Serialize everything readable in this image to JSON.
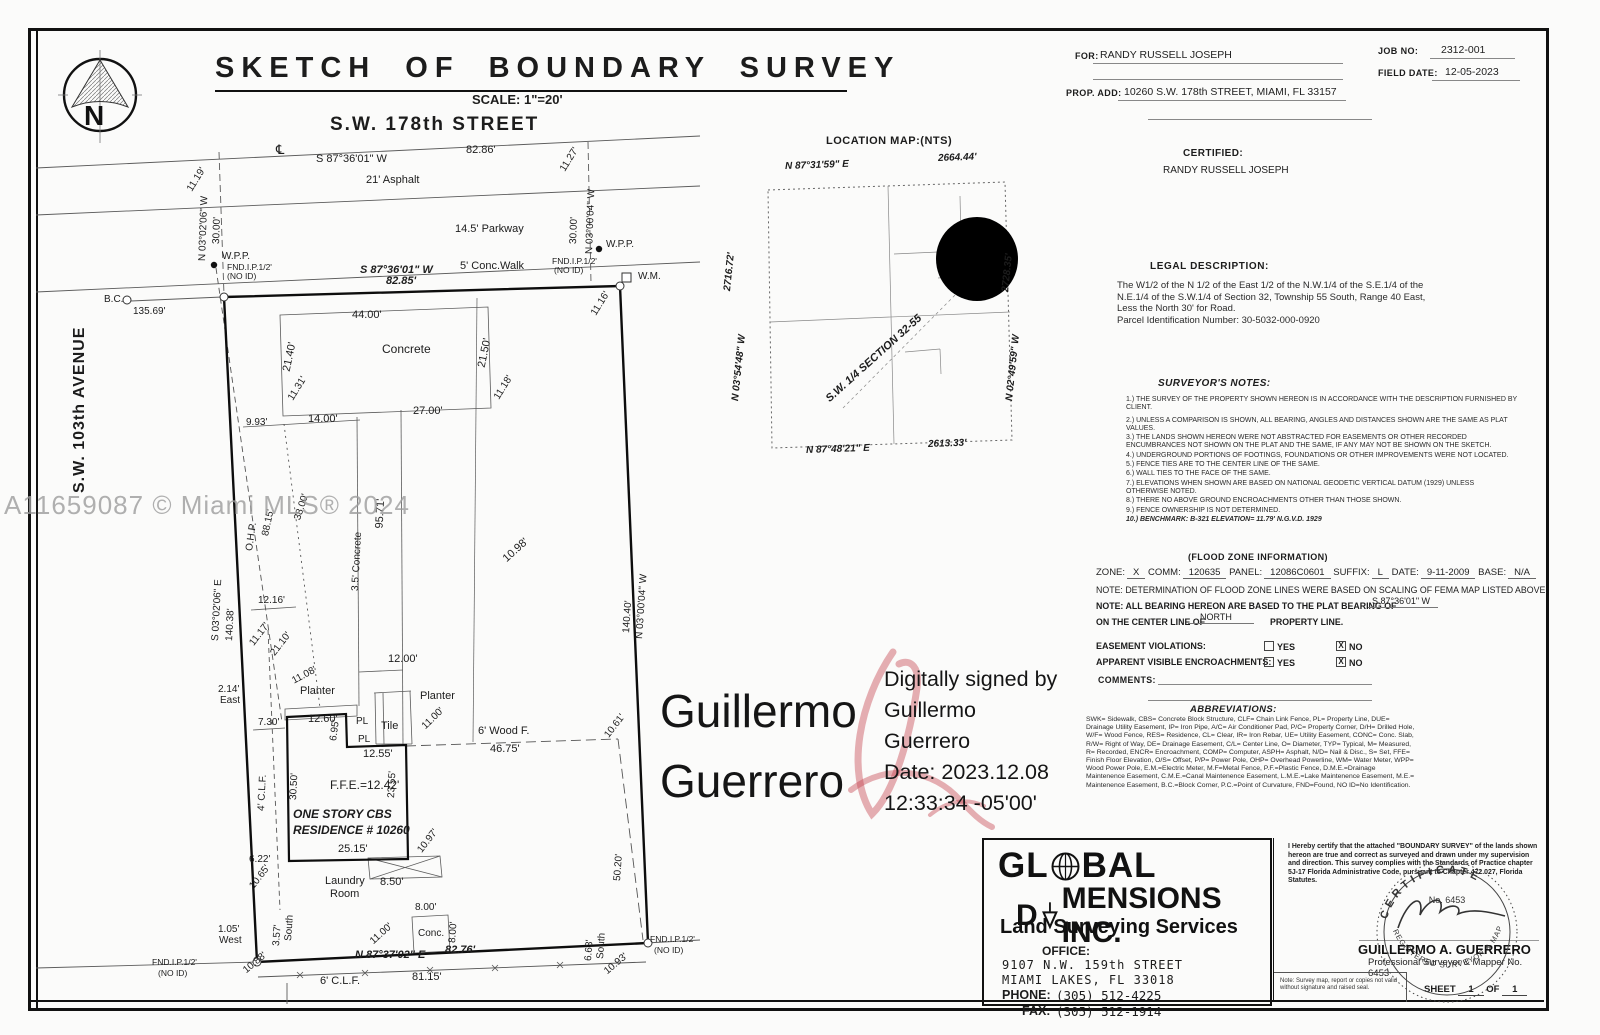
{
  "page": {
    "watermark": "A11659087 © Miami MLS® 2024",
    "north_letter": "N"
  },
  "title": {
    "text": "SKETCH OF BOUNDARY SURVEY",
    "scale": "SCALE: 1\"=20'"
  },
  "header": {
    "for_label": "FOR:",
    "for_value": "RANDY RUSSELL JOSEPH",
    "job_label": "JOB NO:",
    "job_value": "2312-001",
    "field_date_label": "FIELD DATE:",
    "field_date_value": "12-05-2023",
    "prop_label": "PROP. ADD:",
    "prop_value": "10260 S.W. 178th STREET, MIAMI, FL 33157"
  },
  "certified": {
    "label": "CERTIFIED:",
    "value": "RANDY RUSSELL JOSEPH"
  },
  "legal": {
    "heading": "LEGAL DESCRIPTION:",
    "lines": [
      "The W1/2 of the N 1/2 of the East 1/2 of the N.W.1/4 of the S.E.1/4 of the",
      "N.E.1/4 of the S.W.1/4 of Section 32, Township 55 South, Range 40 East,",
      "Less the North 30' for Road.",
      "Parcel Identification Number: 30-5032-000-0920"
    ]
  },
  "surveyor_notes": {
    "heading": "SURVEYOR'S NOTES:",
    "items": [
      "1.) THE SURVEY OF THE PROPERTY SHOWN HEREON IS IN ACCORDANCE WITH THE DESCRIPTION FURNISHED BY CLIENT.",
      "2.) UNLESS A COMPARISON IS SHOWN, ALL BEARING, ANGLES AND DISTANCES SHOWN ARE THE SAME AS PLAT VALUES.",
      "3.) THE LANDS SHOWN HEREON WERE NOT ABSTRACTED FOR EASEMENTS OR OTHER RECORDED ENCUMBRANCES NOT SHOWN ON THE PLAT AND THE SAME, IF ANY MAY NOT BE SHOWN ON THE SKETCH.",
      "4.) UNDERGROUND PORTIONS OF FOOTINGS, FOUNDATIONS OR OTHER IMPROVEMENTS WERE NOT LOCATED.",
      "5.) FENCE TIES ARE TO THE CENTER LINE OF THE SAME.",
      "6.) WALL TIES TO THE FACE OF THE SAME.",
      "7.) ELEVATIONS WHEN SHOWN ARE BASED ON NATIONAL GEODETIC VERTICAL DATUM (1929) UNLESS OTHERWISE NOTED.",
      "8.) THERE NO ABOVE GROUND ENCROACHMENTS OTHER THAN THOSE SHOWN.",
      "9.) FENCE OWNERSHIP IS NOT DETERMINED.",
      "10.) BENCHMARK: B-321 ELEVATION= 11.79' N.G.V.D. 1929"
    ]
  },
  "flood": {
    "heading": "(FLOOD ZONE INFORMATION)",
    "fields": [
      {
        "label": "ZONE:",
        "value": "X"
      },
      {
        "label": "COMM:",
        "value": "120635"
      },
      {
        "label": "PANEL:",
        "value": "12086C0601"
      },
      {
        "label": "SUFFIX:",
        "value": "L"
      },
      {
        "label": "DATE:",
        "value": "9-11-2009"
      },
      {
        "label": "BASE:",
        "value": "N/A"
      }
    ],
    "note1": "NOTE: DETERMINATION OF FLOOD ZONE LINES WERE BASED ON SCALING OF FEMA MAP LISTED ABOVE.",
    "bearing_label": "NOTE: ALL BEARING HEREON ARE BASED TO THE PLAT BEARING OF",
    "bearing_value": "S 87°36'01\" W",
    "centerline_label": "ON THE CENTER LINE OF",
    "centerline_value": "NORTH",
    "centerline_suffix": "PROPERTY LINE.",
    "rows": [
      {
        "label": "EASEMENT VIOLATIONS:",
        "yes": "YES",
        "no": "NO",
        "checked": "no"
      },
      {
        "label": "APPARENT VISIBLE ENCROACHMENTS:",
        "yes": "YES",
        "no": "NO",
        "checked": "no"
      }
    ],
    "check_mark": "X",
    "comments_label": "COMMENTS:"
  },
  "abbreviations": {
    "heading": "ABBREVIATIONS:",
    "text": "SWK= Sidewalk, CBS= Concrete Block Structure, CLF= Chain Link Fence, PL= Property Line, DUE= Drainage Utility Easement, IP= Iron Pipe, A/C= Air Conditioner Pad, P/C= Property Corner, D/H= Drilled Hole, W/F= Wood Fence, RES= Residence, CL= Clear, IR= Iron Rebar, UE= Utility Easement, CONC= Conc. Slab, R/W= Right of Way, DE= Drainage Easement, C/L= Center Line, O= Diameter, TYP= Typical, M= Measured, R= Recorded, ENCR= Encroachment, COMP= Computer, ASPH= Asphalt, N/D= Nail & Disc., S= Set, FFE= Finish Floor Elevation, O/S= Offset, P/P= Power Pole, OHP= Overhead Powerline, WM= Water Meter, WPP= Wood Power Pole, E.M.=Electric Meter, M.F=Metal Fence, P.F.=Plastic Fence, D.M.E.=Drainage Maintenence Easement, C.M.E.=Canal Maintenence Easement, L.M.E.=Lake Maintenence Easement, M.E.= Maintenence Easement, B.C.=Block Corner, P.C.=Point of Curvature, FND=Found, NO ID=No Identification."
  },
  "signature": {
    "name_line1": "Guillermo",
    "name_line2": "Guerrero",
    "details": [
      "Digitally signed by",
      "Guillermo",
      "Guerrero",
      "Date: 2023.12.08",
      "12:33:34 -05'00'"
    ]
  },
  "company": {
    "line1_prefix": "GL",
    "line1_suffix": "BAL",
    "line2_prefix": "D",
    "line2_suffix": "MENSIONS INC.",
    "tagline": "Land Surveying Services",
    "office_label": "OFFICE:",
    "address": [
      "9107 N.W. 159th STREET",
      "MIAMI LAKES, FL 33018"
    ],
    "phone_label": "PHONE:",
    "phone": "(305) 512-4225",
    "fax_label": "FAX:",
    "fax": "(305) 512-1914"
  },
  "certificate": {
    "statement": "I Hereby certify that the attached \"BOUNDARY SURVEY\" of the lands shown hereon are true and correct as surveyed and drawn under my supervision and direction. This survey complies with the Standards of Practice chapter 5J-17 Florida Administrative Code, pursuant to Chapter 472.027, Florida Statutes.",
    "seal": {
      "top": "CERTIFICATE",
      "number": "No. 6453",
      "bottom": "REGISTERED SURVEYOR & MAPPER"
    },
    "name": "GUILLERMO A. GUERRERO",
    "title": "Professional Surveyor & Mapper No. 6453",
    "note": "Note: Survey map, report or copies not valid without signature and raised seal.",
    "sheet_label": "SHEET",
    "sheet_value": "1",
    "of_label": "OF",
    "of_value": "1"
  },
  "location_map": {
    "title": "LOCATION MAP:(NTS)",
    "labels": [
      {
        "t": "N 87°31'59\" E",
        "x": 785,
        "y": 168,
        "s": 10,
        "b": 1,
        "i": 1,
        "r": -2
      },
      {
        "t": "2664.44'",
        "x": 938,
        "y": 160,
        "s": 10,
        "b": 1,
        "i": 1,
        "r": -2
      },
      {
        "t": "2716.72'",
        "x": 728,
        "y": 292,
        "s": 10,
        "b": 1,
        "i": 1,
        "r": -84
      },
      {
        "t": "N 03°54'48\" W",
        "x": 736,
        "y": 402,
        "s": 10,
        "b": 1,
        "i": 1,
        "r": -84
      },
      {
        "t": "2728.35'",
        "x": 1006,
        "y": 293,
        "s": 10,
        "b": 1,
        "i": 1,
        "r": -84
      },
      {
        "t": "N 02°49'59\" W",
        "x": 1010,
        "y": 402,
        "s": 10,
        "b": 1,
        "i": 1,
        "r": -84
      },
      {
        "t": "S.W. 1/4 SECTION 32-55",
        "x": 828,
        "y": 402,
        "s": 11,
        "b": 1,
        "i": 1,
        "r": -42
      },
      {
        "t": "N 87°48'21\" E",
        "x": 806,
        "y": 452,
        "s": 10,
        "b": 1,
        "i": 1,
        "r": -2
      },
      {
        "t": "2613.33'",
        "x": 928,
        "y": 446,
        "s": 10,
        "b": 1,
        "i": 1,
        "r": -2
      }
    ]
  },
  "sketch": {
    "labels": [
      {
        "t": "S.W. 178th STREET",
        "x": 330,
        "y": 127,
        "s": 19,
        "b": 1,
        "ls": 2
      },
      {
        "t": "℄",
        "x": 276,
        "y": 151,
        "s": 13
      },
      {
        "t": "S 87°36'01\" W",
        "x": 316,
        "y": 161,
        "s": 11
      },
      {
        "t": "82.86'",
        "x": 466,
        "y": 152,
        "s": 11
      },
      {
        "t": "21' Asphalt",
        "x": 366,
        "y": 182,
        "s": 11
      },
      {
        "t": "11.19'",
        "x": 190,
        "y": 192,
        "s": 10,
        "r": -58
      },
      {
        "t": "N 03°02'06\" W",
        "x": 203,
        "y": 262,
        "s": 10,
        "r": -88
      },
      {
        "t": "30.00'",
        "x": 217,
        "y": 245,
        "s": 10,
        "r": -88
      },
      {
        "t": "11.27'",
        "x": 563,
        "y": 172,
        "s": 10,
        "r": -58
      },
      {
        "t": "N 03°00'04\" W",
        "x": 590,
        "y": 255,
        "s": 10,
        "r": -88
      },
      {
        "t": "30.00'",
        "x": 574,
        "y": 245,
        "s": 10,
        "r": -88
      },
      {
        "t": "14.5' Parkway",
        "x": 455,
        "y": 231,
        "s": 11
      },
      {
        "t": "W.P.P.",
        "x": 222,
        "y": 258,
        "s": 10
      },
      {
        "t": "W.P.P.",
        "x": 606,
        "y": 246,
        "s": 10
      },
      {
        "t": "FND.I.P.1/2'",
        "x": 227,
        "y": 269,
        "s": 8.5
      },
      {
        "t": "(NO ID)",
        "x": 227,
        "y": 278,
        "s": 8.5
      },
      {
        "t": "S 87°36'01\" W",
        "x": 360,
        "y": 272,
        "s": 11,
        "b": 1,
        "i": 1
      },
      {
        "t": "82.85'",
        "x": 386,
        "y": 283,
        "s": 11,
        "b": 1,
        "i": 1
      },
      {
        "t": "5' Conc.Walk",
        "x": 460,
        "y": 268,
        "s": 11
      },
      {
        "t": "FND.I.P.1/2'",
        "x": 552,
        "y": 263,
        "s": 8.5
      },
      {
        "t": "(NO ID)",
        "x": 554,
        "y": 272,
        "s": 8.5
      },
      {
        "t": "W.M.",
        "x": 638,
        "y": 278,
        "s": 10
      },
      {
        "t": "11.16'",
        "x": 594,
        "y": 316,
        "s": 10,
        "r": -58
      },
      {
        "t": "B.C.",
        "x": 104,
        "y": 301,
        "s": 10
      },
      {
        "t": "135.69'",
        "x": 133,
        "y": 313,
        "s": 10
      },
      {
        "t": "S.W. 103th AVENUE",
        "x": 80,
        "y": 495,
        "s": 16,
        "b": 1,
        "r": -90,
        "ls": 1
      },
      {
        "t": "44.00'",
        "x": 352,
        "y": 317,
        "s": 11
      },
      {
        "t": "Concrete",
        "x": 382,
        "y": 351,
        "s": 12
      },
      {
        "t": "21.40'",
        "x": 287,
        "y": 373,
        "s": 11,
        "r": -78
      },
      {
        "t": "11.31'",
        "x": 291,
        "y": 401,
        "s": 10,
        "r": -58
      },
      {
        "t": "21.50'",
        "x": 482,
        "y": 369,
        "s": 11,
        "r": -78
      },
      {
        "t": "11.18'",
        "x": 497,
        "y": 400,
        "s": 10,
        "r": -58
      },
      {
        "t": "9.93'",
        "x": 246,
        "y": 424,
        "s": 10
      },
      {
        "t": "14.00'",
        "x": 308,
        "y": 421,
        "s": 11
      },
      {
        "t": "27.00'",
        "x": 413,
        "y": 413,
        "s": 11
      },
      {
        "t": "O.H.P.",
        "x": 250,
        "y": 552,
        "s": 10,
        "r": -82
      },
      {
        "t": "88.15'",
        "x": 266,
        "y": 537,
        "s": 10,
        "r": -78
      },
      {
        "t": "38.00'",
        "x": 298,
        "y": 521,
        "s": 10,
        "r": -72
      },
      {
        "t": "95.71'",
        "x": 380,
        "y": 530,
        "s": 11,
        "r": -87
      },
      {
        "t": "3.5' Concrete",
        "x": 356,
        "y": 592,
        "s": 10,
        "r": -87
      },
      {
        "t": "10.98'",
        "x": 505,
        "y": 562,
        "s": 11,
        "r": -42
      },
      {
        "t": "12.16'",
        "x": 258,
        "y": 602,
        "s": 10
      },
      {
        "t": "11.17'",
        "x": 252,
        "y": 646,
        "s": 10,
        "r": -52
      },
      {
        "t": "21.10'",
        "x": 273,
        "y": 656,
        "s": 10,
        "r": -52
      },
      {
        "t": "S 03°02'06\" E",
        "x": 216,
        "y": 642,
        "s": 10,
        "r": -87
      },
      {
        "t": "140.38'",
        "x": 230,
        "y": 642,
        "s": 10,
        "r": -87
      },
      {
        "t": "140.40'",
        "x": 627,
        "y": 634,
        "s": 10,
        "r": -86
      },
      {
        "t": "N 03°00'04\" W",
        "x": 640,
        "y": 640,
        "s": 10,
        "r": -86
      },
      {
        "t": "12.00'",
        "x": 388,
        "y": 661,
        "s": 11
      },
      {
        "t": "2.14'",
        "x": 218,
        "y": 691,
        "s": 10
      },
      {
        "t": "East",
        "x": 220,
        "y": 702,
        "s": 10
      },
      {
        "t": "11.08'",
        "x": 293,
        "y": 683,
        "s": 10,
        "r": -28
      },
      {
        "t": "Planter",
        "x": 300,
        "y": 693,
        "s": 11
      },
      {
        "t": "Planter",
        "x": 420,
        "y": 698,
        "s": 11
      },
      {
        "t": "7.30'",
        "x": 258,
        "y": 724,
        "s": 10
      },
      {
        "t": "12.60'",
        "x": 308,
        "y": 721,
        "s": 11
      },
      {
        "t": "PL",
        "x": 356,
        "y": 723,
        "s": 10
      },
      {
        "t": "6.95'",
        "x": 334,
        "y": 742,
        "s": 10,
        "r": -82
      },
      {
        "t": "PL",
        "x": 358,
        "y": 741,
        "s": 10
      },
      {
        "t": "Tile",
        "x": 381,
        "y": 728,
        "s": 11
      },
      {
        "t": "11.00'",
        "x": 424,
        "y": 729,
        "s": 10,
        "r": -44
      },
      {
        "t": "12.55'",
        "x": 363,
        "y": 756,
        "s": 11
      },
      {
        "t": "6' Wood F.",
        "x": 478,
        "y": 733,
        "s": 11
      },
      {
        "t": "46.75'",
        "x": 490,
        "y": 751,
        "s": 11
      },
      {
        "t": "10.61'",
        "x": 607,
        "y": 738,
        "s": 10,
        "r": -52
      },
      {
        "t": "4' C.L.F.",
        "x": 262,
        "y": 812,
        "s": 10,
        "r": -87
      },
      {
        "t": "30.50'",
        "x": 294,
        "y": 801,
        "s": 10,
        "r": -87
      },
      {
        "t": "23.55'",
        "x": 392,
        "y": 799,
        "s": 10,
        "r": -87
      },
      {
        "t": "F.F.E.=12.42'",
        "x": 330,
        "y": 787,
        "s": 12
      },
      {
        "t": "ONE STORY CBS",
        "x": 293,
        "y": 816,
        "s": 12,
        "b": 1,
        "i": 1
      },
      {
        "t": "RESIDENCE # 10260",
        "x": 293,
        "y": 832,
        "s": 12,
        "b": 1,
        "i": 1
      },
      {
        "t": "25.15'",
        "x": 338,
        "y": 851,
        "s": 11
      },
      {
        "t": "10.97'",
        "x": 420,
        "y": 853,
        "s": 10,
        "r": -52
      },
      {
        "t": "50.20'",
        "x": 618,
        "y": 882,
        "s": 10,
        "r": -86
      },
      {
        "t": "6.22'",
        "x": 249,
        "y": 861,
        "s": 10
      },
      {
        "t": "10.65'",
        "x": 252,
        "y": 889,
        "s": 10,
        "r": -52
      },
      {
        "t": "Laundry",
        "x": 325,
        "y": 883,
        "s": 11
      },
      {
        "t": "Room",
        "x": 330,
        "y": 896,
        "s": 11
      },
      {
        "t": "8.50'",
        "x": 380,
        "y": 884,
        "s": 11
      },
      {
        "t": "8.00'",
        "x": 415,
        "y": 909,
        "s": 10
      },
      {
        "t": "Conc.",
        "x": 418,
        "y": 935,
        "s": 10
      },
      {
        "t": "8.00'",
        "x": 453,
        "y": 944,
        "s": 10,
        "r": -86
      },
      {
        "t": "11.00'",
        "x": 372,
        "y": 944,
        "s": 10,
        "r": -42
      },
      {
        "t": "1.05'",
        "x": 218,
        "y": 931,
        "s": 10
      },
      {
        "t": "West",
        "x": 219,
        "y": 942,
        "s": 10
      },
      {
        "t": "3.57'",
        "x": 277,
        "y": 947,
        "s": 10,
        "r": -86
      },
      {
        "t": "South",
        "x": 289,
        "y": 942,
        "s": 10,
        "r": -86
      },
      {
        "t": "10.88'",
        "x": 245,
        "y": 973,
        "s": 10,
        "r": -40
      },
      {
        "t": "N 87°37'02\" E",
        "x": 355,
        "y": 957,
        "s": 11,
        "b": 1,
        "i": 1
      },
      {
        "t": "82.76'",
        "x": 445,
        "y": 952,
        "s": 11,
        "b": 1,
        "i": 1
      },
      {
        "t": "FND.I.P.1/2'",
        "x": 152,
        "y": 964,
        "s": 8.5
      },
      {
        "t": "(NO ID)",
        "x": 158,
        "y": 975,
        "s": 8.5
      },
      {
        "t": "6' C.L.F.",
        "x": 320,
        "y": 983,
        "s": 11
      },
      {
        "t": "81.15'",
        "x": 412,
        "y": 979,
        "s": 11
      },
      {
        "t": "6.63'",
        "x": 589,
        "y": 962,
        "s": 10,
        "r": -86
      },
      {
        "t": "South",
        "x": 601,
        "y": 960,
        "s": 10,
        "r": -86
      },
      {
        "t": "10.93'",
        "x": 606,
        "y": 974,
        "s": 10,
        "r": -40
      },
      {
        "t": "FND.I.P.1/2'",
        "x": 650,
        "y": 941,
        "s": 8.5
      },
      {
        "t": "(NO ID)",
        "x": 654,
        "y": 952,
        "s": 8.5
      }
    ]
  }
}
